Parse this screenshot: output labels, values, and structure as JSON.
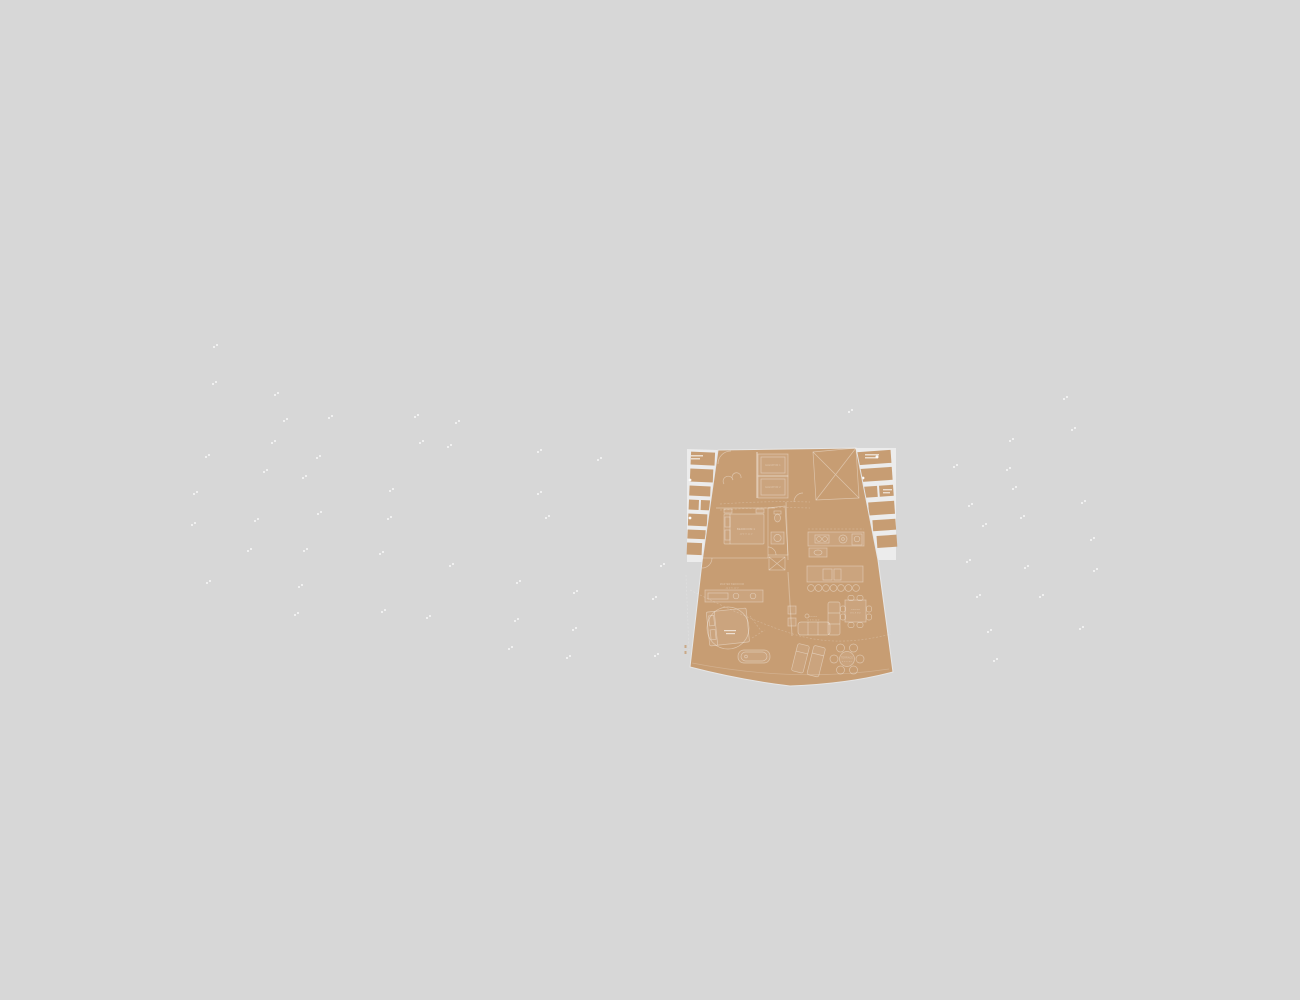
{
  "scene": {
    "background_color": "#d7d7d7",
    "speck_color": "#fbfbfb",
    "description": "Building site plan with one residential unit floor plan highlighted in tan"
  },
  "floorplan": {
    "accent_color": "#c79d73",
    "wall_color": "#ececec",
    "position": {
      "x": 680,
      "y": 440,
      "width": 220,
      "height": 250
    },
    "labels": {
      "elevator_1": "ELEVATOR 1",
      "elevator_2": "ELEVATOR 2",
      "bedroom_1": "BEDROOM 1",
      "bedroom_1_dims": "10'5 X 11'0",
      "master_bedroom": "MASTER BEDROOM",
      "master_dims": "12'5 X 13'0",
      "living": "LIVING",
      "living_dims": "11'0 X 12'5",
      "dining": "DINING",
      "dining_dims": "8'0 X 8'0",
      "terrace": "TERRACE",
      "terrace_dims": "9'0 X 9'0"
    }
  },
  "specks": {
    "points": [
      [
        213,
        346
      ],
      [
        212,
        383
      ],
      [
        274,
        394
      ],
      [
        283,
        420
      ],
      [
        328,
        417
      ],
      [
        414,
        416
      ],
      [
        455,
        422
      ],
      [
        271,
        442
      ],
      [
        419,
        442
      ],
      [
        447,
        446
      ],
      [
        205,
        456
      ],
      [
        316,
        457
      ],
      [
        537,
        451
      ],
      [
        597,
        459
      ],
      [
        263,
        471
      ],
      [
        302,
        477
      ],
      [
        389,
        490
      ],
      [
        193,
        493
      ],
      [
        537,
        493
      ],
      [
        317,
        513
      ],
      [
        387,
        518
      ],
      [
        545,
        517
      ],
      [
        254,
        520
      ],
      [
        191,
        524
      ],
      [
        247,
        550
      ],
      [
        303,
        550
      ],
      [
        379,
        553
      ],
      [
        206,
        582
      ],
      [
        298,
        586
      ],
      [
        294,
        614
      ],
      [
        381,
        611
      ],
      [
        426,
        617
      ],
      [
        449,
        565
      ],
      [
        516,
        582
      ],
      [
        573,
        592
      ],
      [
        660,
        565
      ],
      [
        652,
        598
      ],
      [
        514,
        620
      ],
      [
        572,
        629
      ],
      [
        508,
        648
      ],
      [
        566,
        657
      ],
      [
        654,
        655
      ],
      [
        848,
        411
      ],
      [
        1063,
        398
      ],
      [
        1071,
        429
      ],
      [
        1009,
        440
      ],
      [
        953,
        466
      ],
      [
        1006,
        469
      ],
      [
        1012,
        488
      ],
      [
        1081,
        502
      ],
      [
        968,
        505
      ],
      [
        1020,
        517
      ],
      [
        982,
        525
      ],
      [
        1090,
        539
      ],
      [
        966,
        561
      ],
      [
        1024,
        567
      ],
      [
        1093,
        570
      ],
      [
        976,
        596
      ],
      [
        1039,
        596
      ],
      [
        1079,
        628
      ],
      [
        987,
        631
      ],
      [
        993,
        660
      ]
    ]
  }
}
